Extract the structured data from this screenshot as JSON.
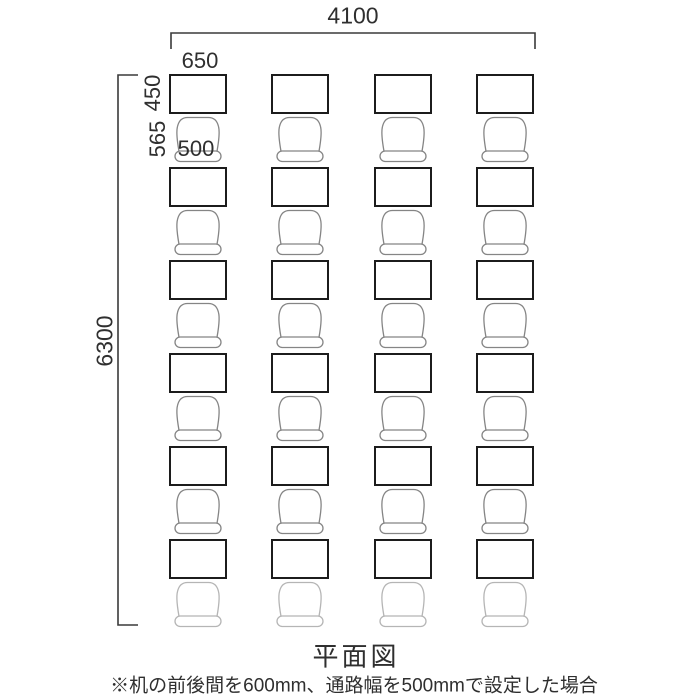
{
  "title": "平面図",
  "note": "※机の前後間を600mm、通路幅を500mmで設定した場合",
  "dimensions": {
    "total_width": "4100",
    "total_height": "6300",
    "desk_width": "650",
    "desk_depth": "450",
    "chair_pitch": "565",
    "chair_width": "500"
  },
  "layout": {
    "columns": 4,
    "rows": 6,
    "desk_count": 24
  },
  "colors": {
    "desk_stroke": "#1c1c1c",
    "chair_stroke": "#858585",
    "chair_stroke_light": "#b5b5b5",
    "dim_line": "#3a3a3a",
    "text": "#2f2f2f"
  }
}
